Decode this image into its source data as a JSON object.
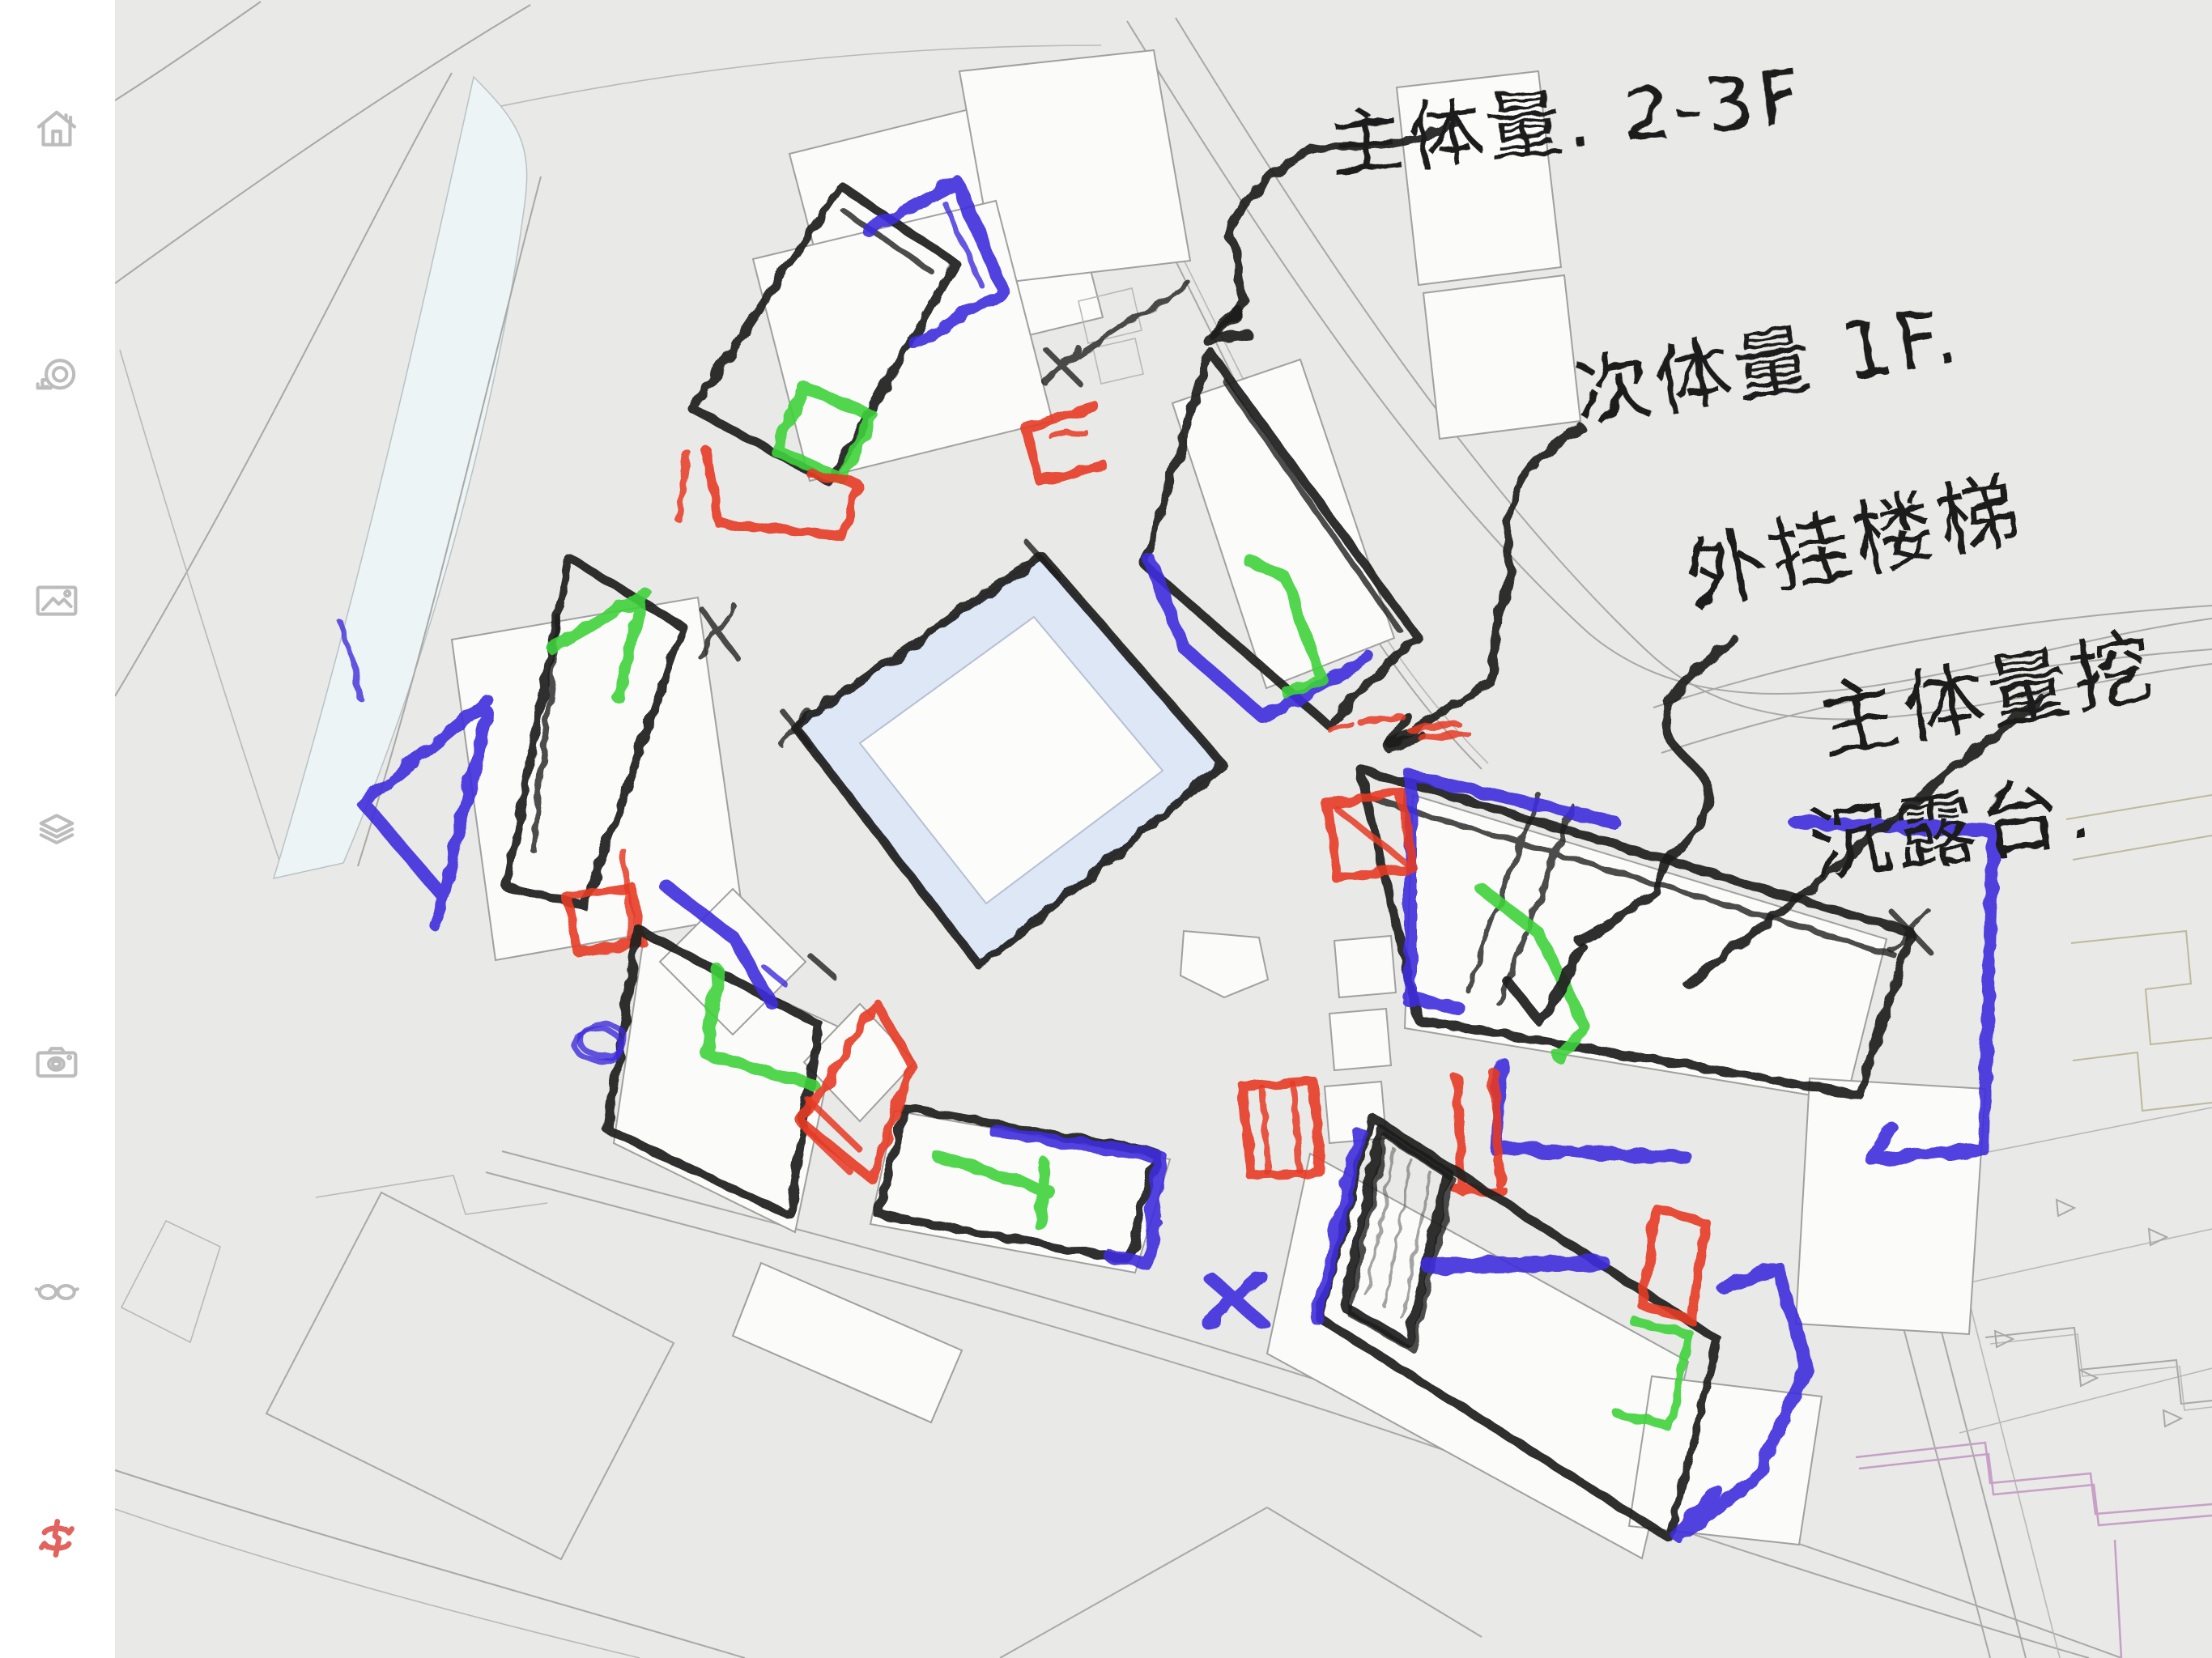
{
  "sidebar": {
    "background": "#ffffff",
    "tools": [
      {
        "id": "home",
        "icon": "home-icon"
      },
      {
        "id": "measure",
        "icon": "tape-measure-icon"
      },
      {
        "id": "import-image",
        "icon": "image-icon"
      },
      {
        "id": "layers",
        "icon": "layers-icon"
      },
      {
        "id": "camera",
        "icon": "camera-icon"
      },
      {
        "id": "view",
        "icon": "glasses-icon"
      },
      {
        "id": "brand",
        "icon": "brand-rotate-icon",
        "color": "#e2635e"
      }
    ]
  },
  "canvas": {
    "background": "#e9e9e7",
    "base_map": {
      "cad_line": "#a8a8a6",
      "footprint_fill": "#fbfbfa",
      "water_fill": "#edf4f6",
      "plaza_band_fill": "#dde7f5",
      "boundary_accent": "#c79fc7",
      "parcel_accent": "#bdb99c"
    },
    "ink_palette": {
      "black": "#1e1e1e",
      "blue": "#3e2bdc",
      "green": "#3ed23b",
      "red": "#e63b25"
    }
  },
  "annotations": {
    "notes": [
      {
        "id": "main-volume",
        "text": "主体量. 2-3F"
      },
      {
        "id": "secondary-volume",
        "text": "次体量 1F."
      },
      {
        "id": "external-stair",
        "text": "外挂楼梯"
      },
      {
        "id": "carve-line1",
        "text": "主体量挖"
      },
      {
        "id": "carve-line2",
        "text": "沉露台."
      }
    ]
  }
}
